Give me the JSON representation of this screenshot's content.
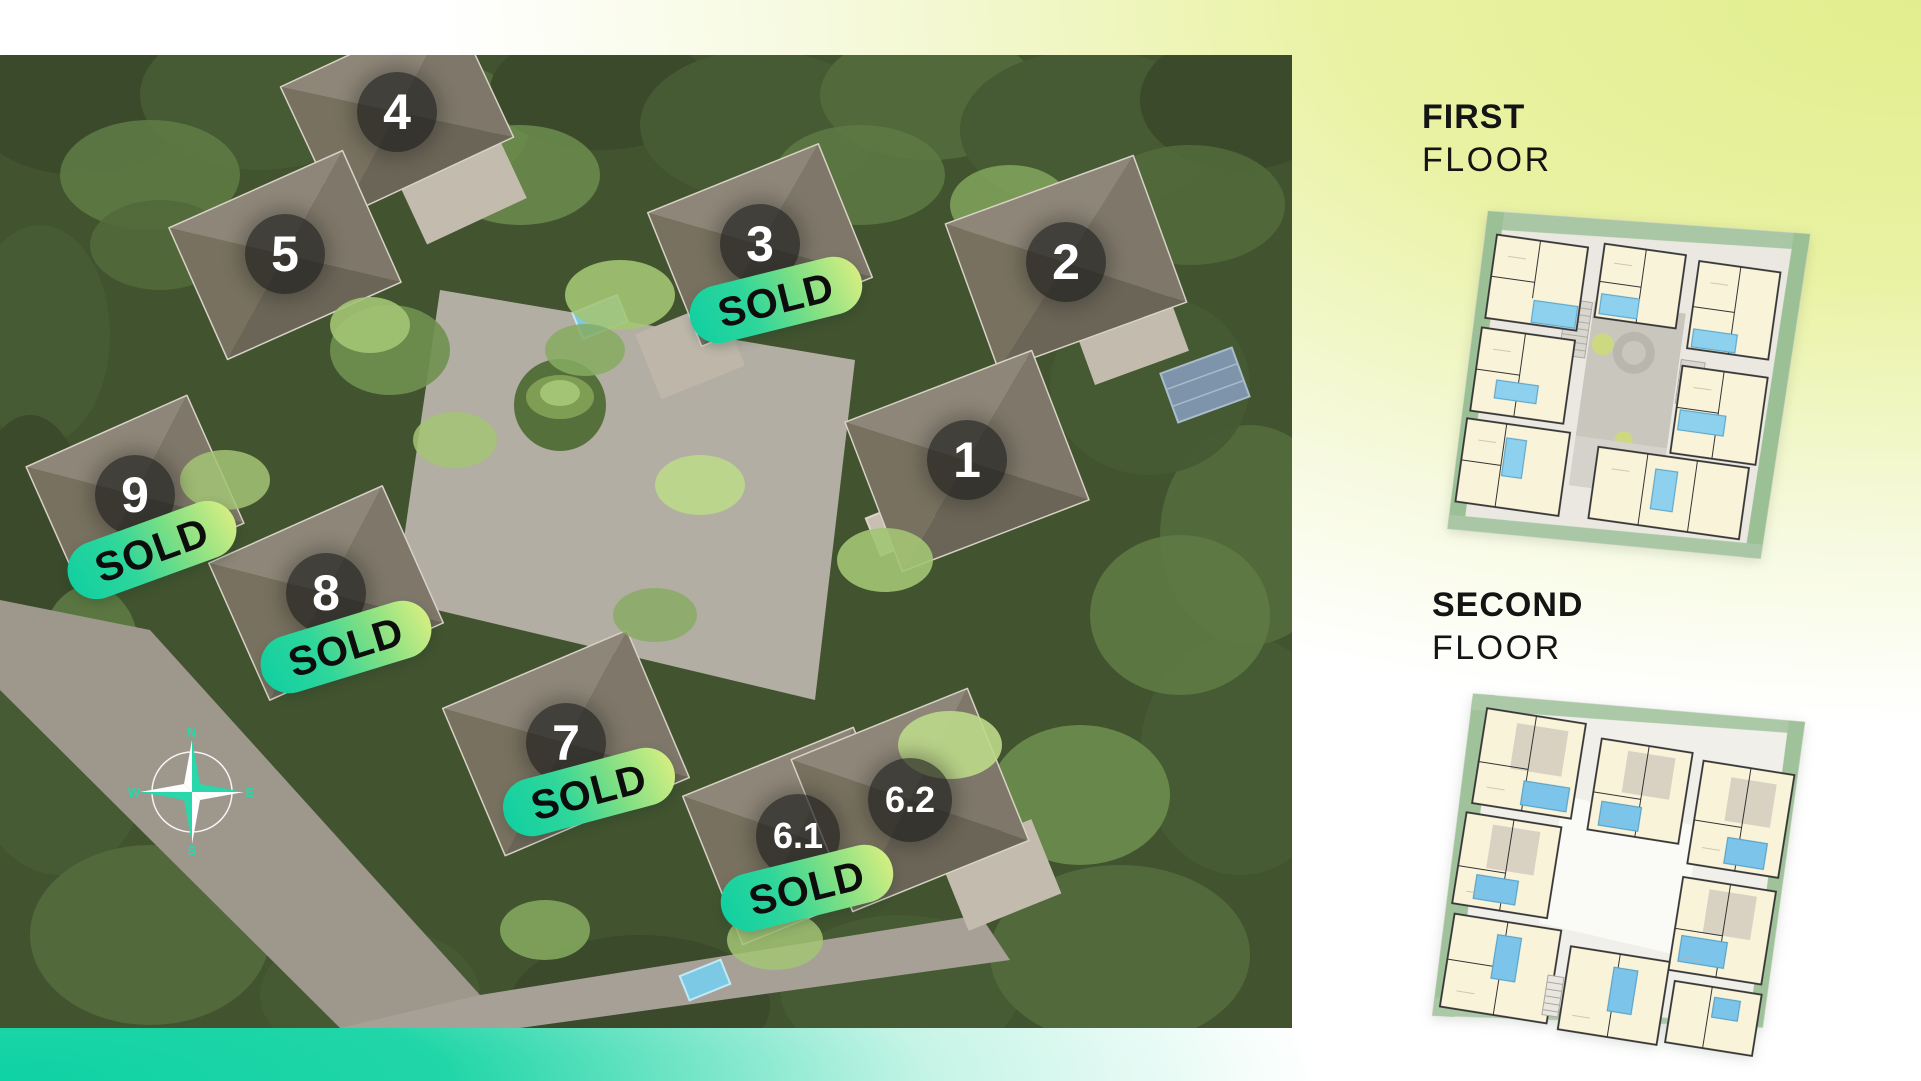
{
  "page": {
    "width": 1921,
    "height": 1081
  },
  "colors": {
    "teal_accent": "#12d1a2",
    "yellow_green_accent": "#e9f2a2",
    "sold_gradient_start": "#10cfa2",
    "sold_gradient_end": "#dcef82",
    "marker_circle": "rgba(28,28,28,0.66)",
    "marker_text": "#ffffff",
    "sold_text": "#0d0d0d",
    "heading_text": "#141414"
  },
  "aerial": {
    "markers": [
      {
        "label": "4",
        "sold": false
      },
      {
        "label": "5",
        "sold": false
      },
      {
        "label": "3",
        "sold": true
      },
      {
        "label": "2",
        "sold": false
      },
      {
        "label": "1",
        "sold": false
      },
      {
        "label": "9",
        "sold": true
      },
      {
        "label": "8",
        "sold": true
      },
      {
        "label": "7",
        "sold": true
      },
      {
        "label": "6.1",
        "sold": true
      },
      {
        "label": "6.2",
        "sold": false
      }
    ],
    "sold_label": "SOLD",
    "compass": {
      "north": "N",
      "east": "E",
      "south": "S",
      "west": "W"
    }
  },
  "panel": {
    "first_floor": {
      "title_line1": "FIRST",
      "title_line2": "FLOOR"
    },
    "second_floor": {
      "title_line1": "SECOND",
      "title_line2": "FLOOR"
    }
  }
}
